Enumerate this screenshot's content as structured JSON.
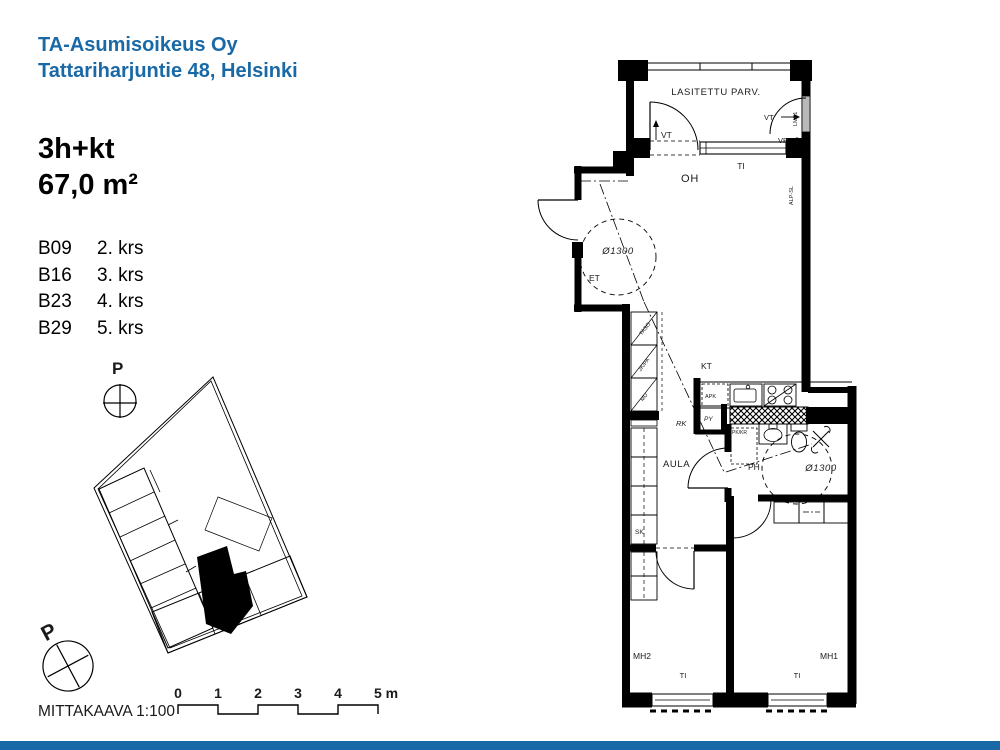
{
  "header": {
    "line1": "TA-Asumisoikeus Oy",
    "line2": "Tattariharjuntie 48, Helsinki"
  },
  "apartment": {
    "type": "3h+kt",
    "area": "67,0 m²",
    "units": [
      {
        "id": "B09",
        "floor": "2. krs"
      },
      {
        "id": "B16",
        "floor": "3. krs"
      },
      {
        "id": "B23",
        "floor": "4. krs"
      },
      {
        "id": "B29",
        "floor": "5. krs"
      }
    ]
  },
  "compass": {
    "north1": "P",
    "north2": "P"
  },
  "scalebar": {
    "label": "MITTAKAAVA 1:100",
    "ticks": [
      "0",
      "1",
      "2",
      "3",
      "4",
      "5 m"
    ]
  },
  "plan": {
    "labels": {
      "balcony": "LASITETTU PARV.",
      "vt_right": "VT",
      "vp": "VP",
      "vt_top": "VT",
      "ti_living": "TI",
      "living": "OH",
      "entry": "ET",
      "circle_entry": "Ø1300",
      "circle_bath": "Ø1300",
      "kitchen": "KT",
      "dishwasher": "APK",
      "py": "PY",
      "rk": "RK",
      "washer_dryer": "PK/KR",
      "bath": "PH",
      "hall": "AULA",
      "cleaning_closet": "SK",
      "bedroom1": "MH1",
      "bedroom2": "MH2",
      "ti_bedroom1": "TI",
      "ti_bedroom2": "TI",
      "counter": "TASO",
      "fridge_freezer": "JK/PA",
      "microwave": "MU",
      "duct_label_upper": "LMP1",
      "duct_label_lower": "ALP-SL"
    }
  },
  "colors": {
    "brand_blue": "#1a69a7"
  }
}
